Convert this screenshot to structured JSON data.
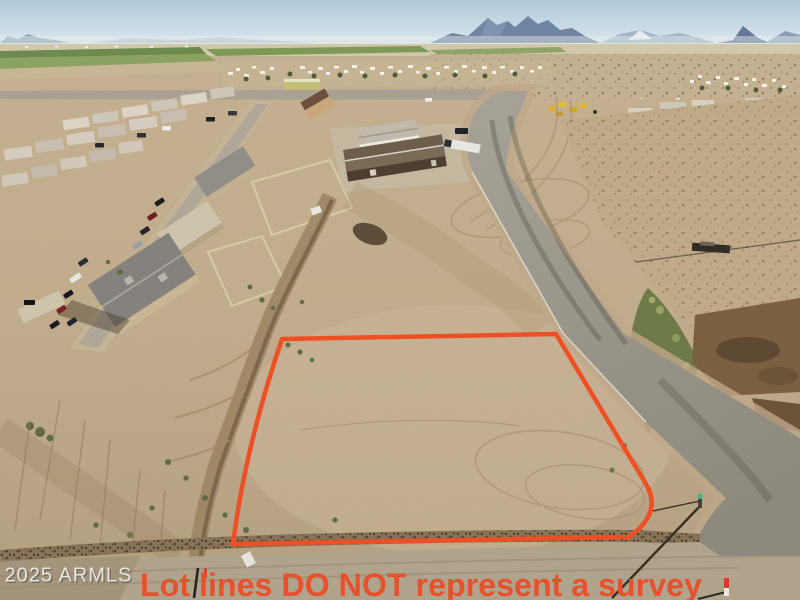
{
  "photo": {
    "kind": "aerial-drone-photo",
    "subject": "vacant graded desert lot outlined in red beside a paved road, desert homes to the left, mountains on the horizon",
    "watermark": {
      "text": "2025 ARMLS",
      "color": "#ffffff"
    },
    "disclaimer": {
      "text": "Lot lines DO NOT represent a survey",
      "color": "#e8512b"
    },
    "lot_outline": {
      "color": "#ee4f25"
    },
    "palette": {
      "sky": "#b9cfdf",
      "mountains": "#6f85a3",
      "dirt": "#c0aa8a",
      "road": "#9b968b",
      "field_green": "#6d8a4e"
    }
  }
}
